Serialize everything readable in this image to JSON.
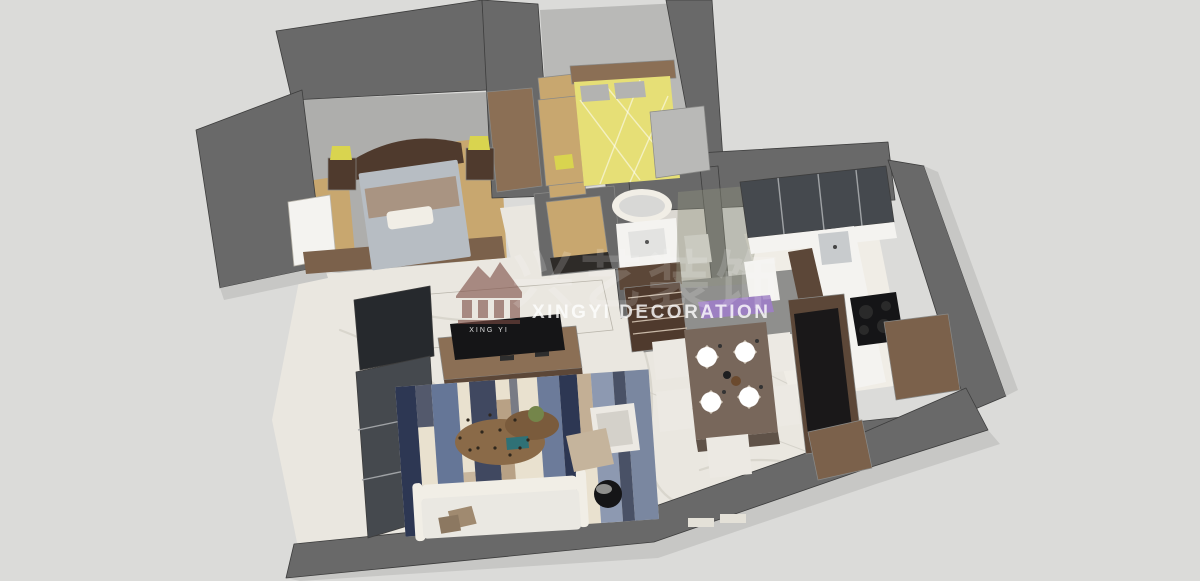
{
  "watermark": {
    "logo_subtitle": "XING YI",
    "brand_cjk": "兴艺装饰",
    "brand_text": "XINGYI DECORATION"
  },
  "colors": {
    "bg": "#dbdbd9",
    "wall": "#696969",
    "wall_light": "#8f8f8d",
    "wall_pale": "#c7c7c5",
    "floor_gray": "#aeaeac",
    "floor_gray2": "#b9b9b7",
    "marble": "#eae7e0",
    "tile": "#dcd9d3",
    "kitchen_floor": "#f0ede6",
    "wood_light": "#c8a76f",
    "wood_mid": "#8b6f55",
    "wood_dark": "#4f3a2d",
    "walnut": "#5c4738",
    "cabinet_brown": "#7b614b",
    "coffee_brown": "#8a6a48",
    "coffee_brown2": "#7a5b3c",
    "table_brown": "#78675b",
    "table_edge": "#5f5248",
    "bed_yellow": "#e6df76",
    "lamp_yellow": "#d9d44f",
    "duvet_gray": "#b7bdc3",
    "pillow_gray": "#b3b3b1",
    "blanket_tan": "#a99482",
    "pillow_tan": "#a08a70",
    "pillow_tan2": "#8c7861",
    "ottoman_tan": "#c5b49c",
    "linen": "#f1eee6",
    "sofa": "#eae8e2",
    "chair_white": "#ece9e3",
    "chair_seat": "#d4d1ca",
    "napkin": "#d8cfc2",
    "rug_cream": "#e9e1cf",
    "rug_navy": "#2d3753",
    "rug_steel": "#5e7094",
    "rug_slate": "#8391ad",
    "rug_tan": "#b29a7c",
    "purple": "#9d80c2",
    "teal": "#2f7176",
    "plant": "#74854a",
    "black": "#151517",
    "glass": "#45494e",
    "glass_pane": "#90927f",
    "curtain": "#26292d",
    "steel": "#c8cbcd",
    "white": "#f4f3f0",
    "threshold": "#2e2b28",
    "guide": "#4c4c4c",
    "watermark_red": "#7c4b43",
    "watermark_white": "#ffffff"
  }
}
